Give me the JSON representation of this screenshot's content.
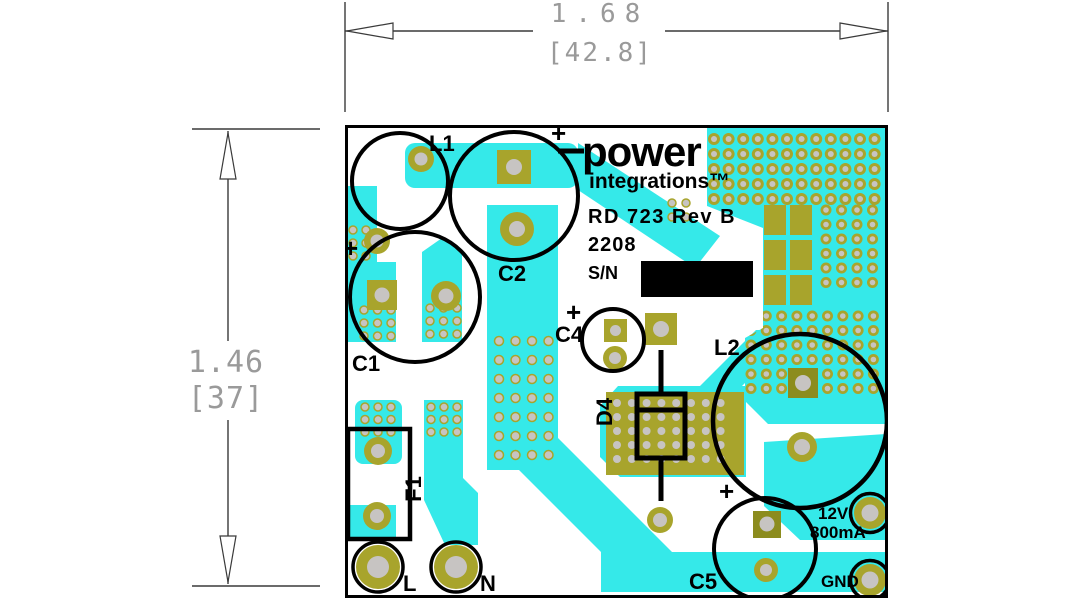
{
  "figure": {
    "dim_width": {
      "inches": "1.68",
      "mm": "[42.8]"
    },
    "dim_height": {
      "inches": "1.46",
      "mm": "[37]"
    }
  },
  "logo": {
    "word1": "power",
    "word2": "integrations™"
  },
  "silkscreen": {
    "model": "RD 723 Rev B",
    "date_code": "2208",
    "serial_label": "S/N",
    "plus": "+",
    "refs": {
      "l1": "L1",
      "c1": "C1",
      "c2": "C2",
      "c4": "C4",
      "c5": "C5",
      "d4": "D4",
      "f1": "F1",
      "l2": "L2"
    },
    "terminals": {
      "line": "L",
      "neutral": "N",
      "ground": "GND",
      "vout": "12V",
      "iout": "800mA"
    }
  },
  "colors": {
    "trace_cyan": "#35e9e9",
    "pad_olive": "#a8a42c",
    "pad_olive_dark": "#8c8c1e",
    "hole_gray": "#c7c4c2",
    "silk_black": "#000000",
    "dim_text_gray": "#9a9a9a",
    "dim_line": "#3a3a3a"
  }
}
